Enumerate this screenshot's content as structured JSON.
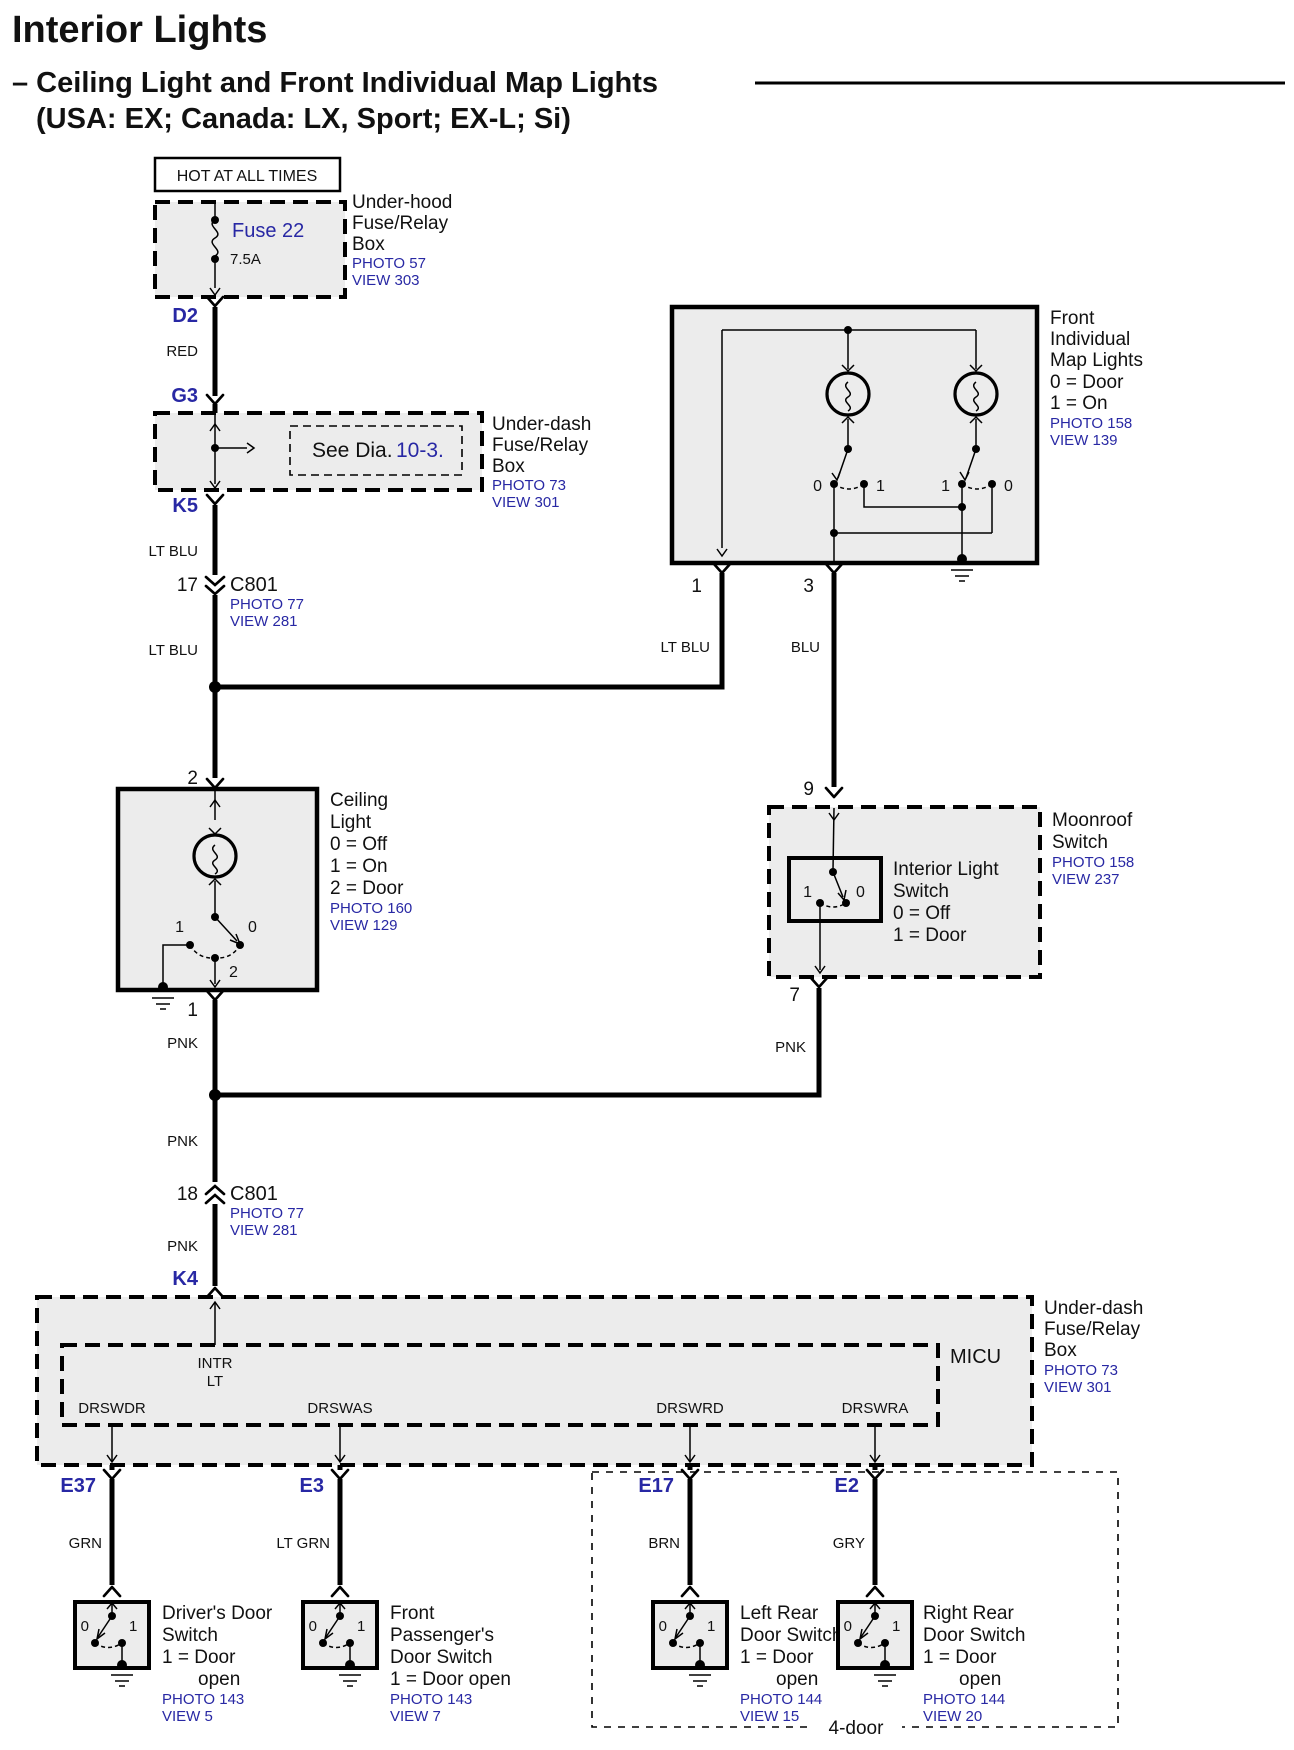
{
  "header": {
    "title": "Interior Lights",
    "subtitle": "– Ceiling Light and Front Individual Map Lights",
    "variants": "(USA: EX; Canada: LX, Sport; EX-L; Si)"
  },
  "colors": {
    "link_blue": "#2828a4",
    "box_fill": "#ececec"
  },
  "power_label": "HOT AT ALL TIMES",
  "underhood": {
    "fuse": "Fuse 22",
    "amps": "7.5A",
    "line1": "Under-hood",
    "line2": "Fuse/Relay",
    "line3": "Box",
    "photo": "PHOTO 57",
    "view": "VIEW 303"
  },
  "underdash": {
    "see": "See Dia.",
    "ref": "10-3.",
    "line1": "Under-dash",
    "line2": "Fuse/Relay",
    "line3": "Box",
    "photo": "PHOTO 73",
    "view": "VIEW 301"
  },
  "terminals": {
    "d2": "D2",
    "g3": "G3",
    "k5": "K5",
    "k4": "K4",
    "pin17": "17",
    "pin18": "18",
    "c801": "C801",
    "c801_photo": "PHOTO 77",
    "c801_view": "VIEW 281"
  },
  "wires": {
    "red": "RED",
    "lt_blu": "LT BLU",
    "blu": "BLU",
    "pnk": "PNK"
  },
  "map_lights": {
    "pin_left": "1",
    "pin_right": "3",
    "line1": "Front",
    "line2": "Individual",
    "line3": "Map Lights",
    "line4": "0 = Door",
    "line5": "1 = On",
    "photo": "PHOTO 158",
    "view": "VIEW 139",
    "sw_l0": "0",
    "sw_l1": "1",
    "sw_r1": "1",
    "sw_r0": "0"
  },
  "ceiling": {
    "pin_top": "2",
    "pin_bottom": "1",
    "line1": "Ceiling",
    "line2": "Light",
    "line3": "0 = Off",
    "line4": "1 = On",
    "line5": "2 = Door",
    "photo": "PHOTO 160",
    "view": "VIEW 129",
    "sw_1": "1",
    "sw_0": "0",
    "sw_2": "2"
  },
  "moonroof": {
    "pin_top": "9",
    "pin_bottom": "7",
    "line1": "Moonroof",
    "line2": "Switch",
    "photo": "PHOTO 158",
    "view": "VIEW 237",
    "inner1": "Interior Light",
    "inner2": "Switch",
    "inner3": "0 = Off",
    "inner4": "1 = Door",
    "sw_1": "1",
    "sw_0": "0"
  },
  "micu": {
    "label": "MICU",
    "intr1": "INTR",
    "intr2": "LT",
    "pin1": "DRSWDR",
    "pin2": "DRSWAS",
    "pin3": "DRSWRD",
    "pin4": "DRSWRA",
    "line1": "Under-dash",
    "line2": "Fuse/Relay",
    "line3": "Box",
    "photo": "PHOTO 73",
    "view": "VIEW 301"
  },
  "four_door_label": "4-door",
  "doors": [
    {
      "conn": "E37",
      "wire": "GRN",
      "l1": "Driver's Door",
      "l2": "Switch",
      "l3": "1 = Door",
      "l4": "open",
      "photo": "PHOTO 143",
      "view": "VIEW 5",
      "sw0": "0",
      "sw1": "1"
    },
    {
      "conn": "E3",
      "wire": "LT GRN",
      "l1": "Front",
      "l2": "Passenger's",
      "l3": "Door Switch",
      "l4": "1 = Door open",
      "photo": "PHOTO 143",
      "view": "VIEW 7",
      "sw0": "0",
      "sw1": "1"
    },
    {
      "conn": "E17",
      "wire": "BRN",
      "l1": "Left Rear",
      "l2": "Door Switch",
      "l3": "1 = Door",
      "l4": "open",
      "photo": "PHOTO 144",
      "view": "VIEW 15",
      "sw0": "0",
      "sw1": "1"
    },
    {
      "conn": "E2",
      "wire": "GRY",
      "l1": "Right Rear",
      "l2": "Door Switch",
      "l3": "1 = Door",
      "l4": "open",
      "photo": "PHOTO 144",
      "view": "VIEW 20",
      "sw0": "0",
      "sw1": "1"
    }
  ]
}
